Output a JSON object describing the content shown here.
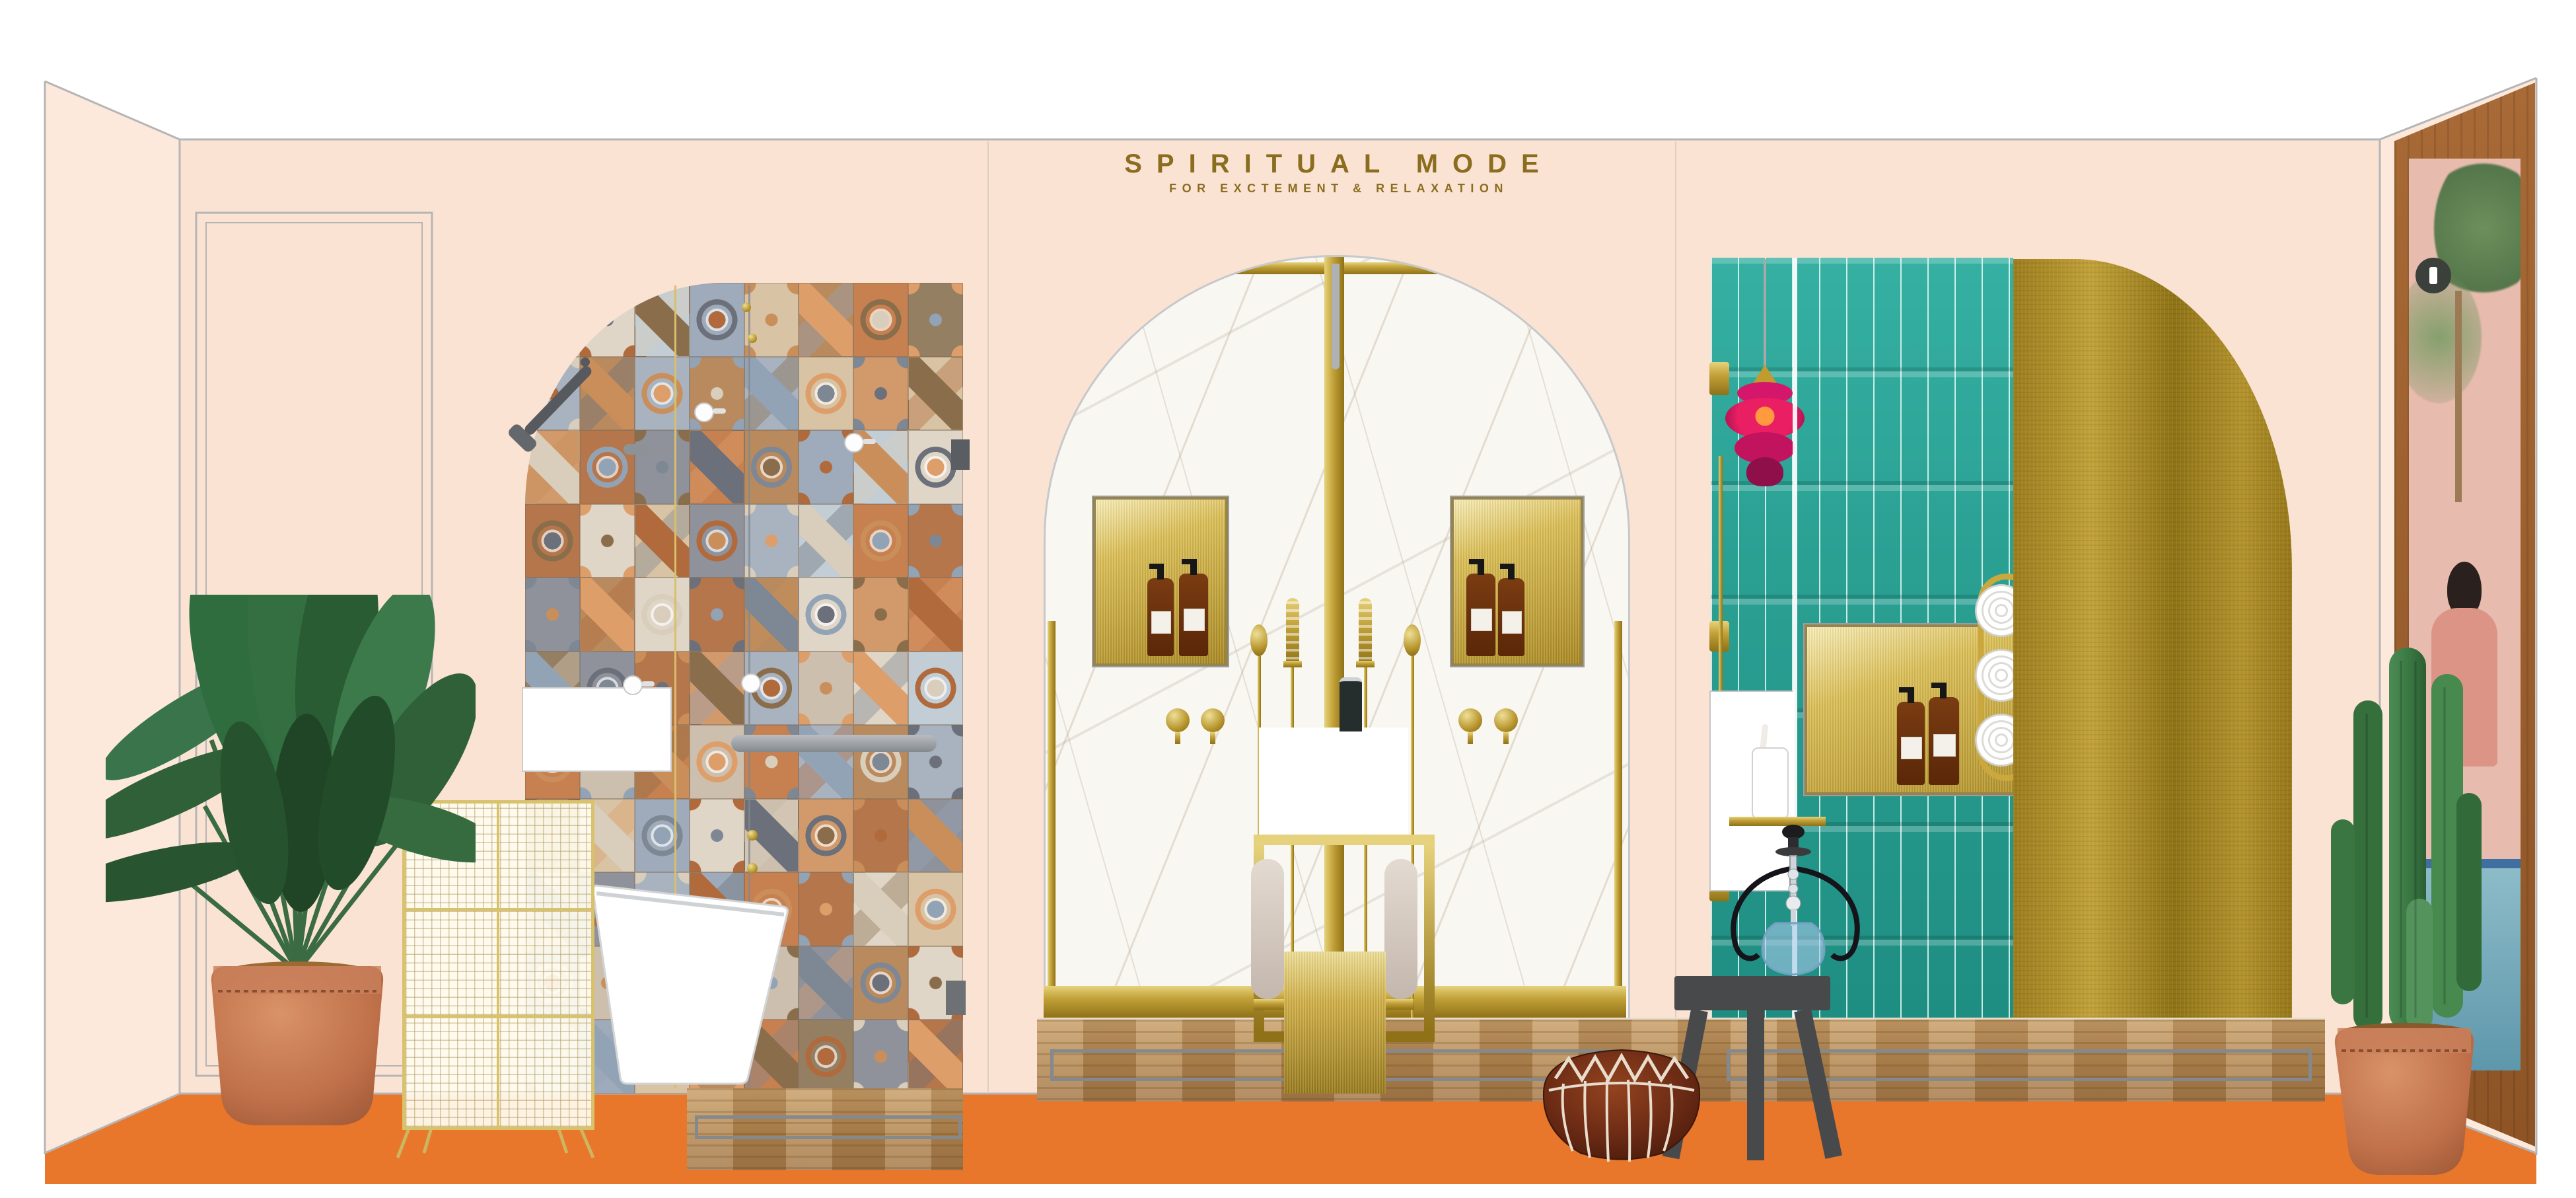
{
  "header": {
    "title": "SPIRITUAL MODE",
    "subtitle": "FOR EXCTEMENT & RELAXATION"
  },
  "colors": {
    "bg": "#ffffff",
    "wall": "#fbe3d4",
    "wall_side": "#fde9db",
    "line": "#b5b5b5",
    "seam": "#dccfc2",
    "floor": "#e8762b",
    "gold_text": "#8a6d1f",
    "brass": "#c2a138",
    "brass_dark": "#8f7117",
    "teal": "#2aa093",
    "marble": "#f9f7f2",
    "wood_a": "#c9a06b",
    "wood_b": "#b1854f",
    "gray_fixture": "#565a5e",
    "pouf_brown": "#6e2c15",
    "terracotta": "#c0714a",
    "magenta_lamp": "#e91e63",
    "leaf_green": "#2f6038"
  },
  "moroccan_palette": [
    "#cdbfae",
    "#b98a5d",
    "#d29a6b",
    "#9fabba",
    "#8f929b",
    "#e0d6c8",
    "#c7804f",
    "#a9b3c0",
    "#d8c3a4",
    "#b4764a",
    "#c2cdd6",
    "#947f63"
  ],
  "moroccan_accents": [
    "#7e8794",
    "#b06a3c",
    "#d9cdbb",
    "#6b707a",
    "#c98e5a",
    "#93a3b6",
    "#8a6d4a",
    "#dd9e6a"
  ]
}
